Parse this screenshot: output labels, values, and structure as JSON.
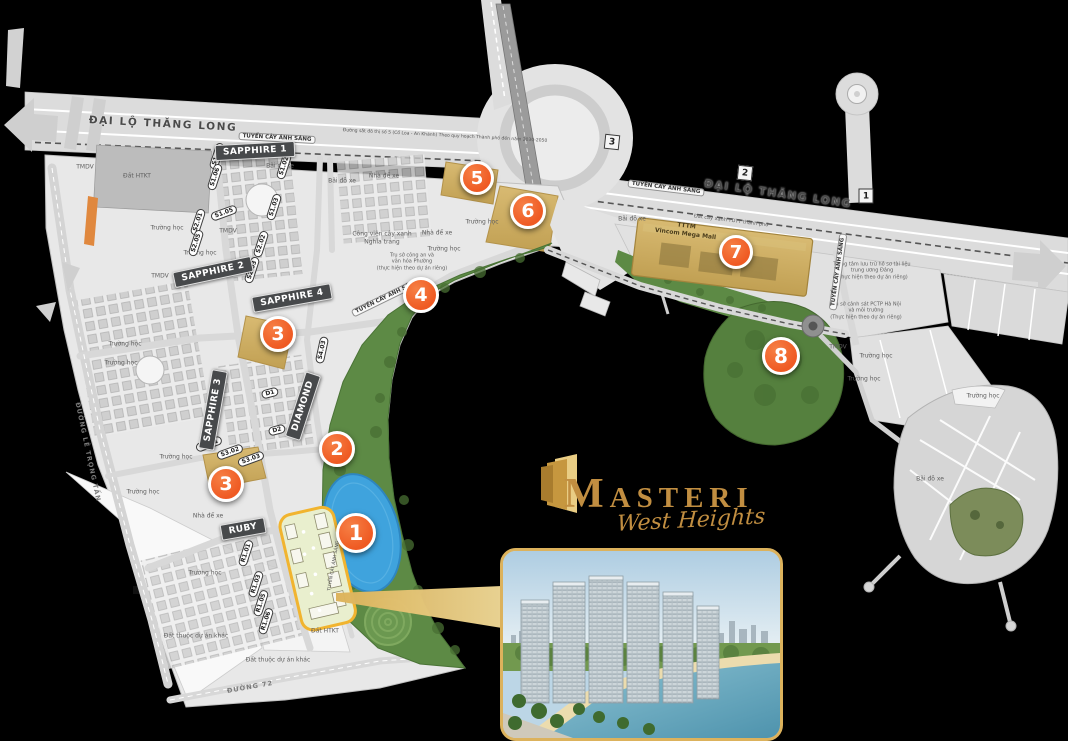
{
  "canvas": {
    "width": 1068,
    "height": 741,
    "background": "#000000"
  },
  "colors": {
    "marker_orange": "#ef5a23",
    "zone_badge": "#47494b",
    "gold": "#c18e41",
    "site_outline": "#f1b42f",
    "park_green": "#5d8a45",
    "lake_blue": "#3fa3dd",
    "mall_tan": "#c9ab61",
    "inset_border": "#dcb25c"
  },
  "logo": {
    "brand": "MASTERI",
    "subbrand": "West Heights"
  },
  "markers": [
    {
      "n": "1",
      "x": 356,
      "y": 533,
      "r": 17
    },
    {
      "n": "2",
      "x": 337,
      "y": 449,
      "r": 15
    },
    {
      "n": "3",
      "x": 278,
      "y": 334,
      "r": 15
    },
    {
      "n": "3",
      "x": 226,
      "y": 484,
      "r": 15
    },
    {
      "n": "4",
      "x": 421,
      "y": 295,
      "r": 15
    },
    {
      "n": "5",
      "x": 477,
      "y": 178,
      "r": 14
    },
    {
      "n": "6",
      "x": 528,
      "y": 211,
      "r": 15
    },
    {
      "n": "7",
      "x": 736,
      "y": 252,
      "r": 14
    },
    {
      "n": "8",
      "x": 781,
      "y": 356,
      "r": 16
    }
  ],
  "road_badges": [
    {
      "n": "3",
      "x": 612,
      "y": 142,
      "rot": 6
    },
    {
      "n": "2",
      "x": 745,
      "y": 173,
      "rot": 6
    },
    {
      "n": "1",
      "x": 866,
      "y": 196,
      "rot": 0
    }
  ],
  "zone_badges": [
    {
      "t": "SAPPHIRE 1",
      "x": 255,
      "y": 151,
      "rot": -3
    },
    {
      "t": "SAPPHIRE 2",
      "x": 213,
      "y": 272,
      "rot": -12
    },
    {
      "t": "SAPPHIRE 4",
      "x": 292,
      "y": 298,
      "rot": -10
    },
    {
      "t": "SAPPHIRE 3",
      "x": 213,
      "y": 410,
      "rot": -80
    },
    {
      "t": "DIAMOND",
      "x": 303,
      "y": 406,
      "rot": -72
    },
    {
      "t": "RUBY",
      "x": 243,
      "y": 529,
      "rot": -10
    }
  ],
  "unit_labels": [
    {
      "t": "S1.01",
      "x": 217,
      "y": 156,
      "rot": -72
    },
    {
      "t": "S1.06",
      "x": 215,
      "y": 177,
      "rot": -72
    },
    {
      "t": "S1.02",
      "x": 284,
      "y": 166,
      "rot": -72
    },
    {
      "t": "S1.03",
      "x": 274,
      "y": 207,
      "rot": -72
    },
    {
      "t": "S1.05",
      "x": 224,
      "y": 213,
      "rot": -20
    },
    {
      "t": "S2.01",
      "x": 198,
      "y": 222,
      "rot": -72
    },
    {
      "t": "S2.05",
      "x": 196,
      "y": 243,
      "rot": -72
    },
    {
      "t": "S2.02",
      "x": 261,
      "y": 244,
      "rot": -72
    },
    {
      "t": "S2.03",
      "x": 252,
      "y": 270,
      "rot": -72
    },
    {
      "t": "S3.01",
      "x": 209,
      "y": 444,
      "rot": -20
    },
    {
      "t": "S3.02",
      "x": 230,
      "y": 452,
      "rot": -20
    },
    {
      "t": "S3.03",
      "x": 251,
      "y": 459,
      "rot": -20
    },
    {
      "t": "S4.03",
      "x": 322,
      "y": 350,
      "rot": -78
    },
    {
      "t": "D1",
      "x": 270,
      "y": 393,
      "rot": -15
    },
    {
      "t": "D2",
      "x": 277,
      "y": 430,
      "rot": -15
    },
    {
      "t": "R1.01",
      "x": 246,
      "y": 553,
      "rot": -72
    },
    {
      "t": "R1.03",
      "x": 256,
      "y": 584,
      "rot": -72
    },
    {
      "t": "R1.05",
      "x": 261,
      "y": 603,
      "rot": -72
    },
    {
      "t": "R1.06",
      "x": 266,
      "y": 621,
      "rot": -72
    }
  ],
  "road_labels": [
    {
      "t": "ĐẠI LỘ THĂNG LONG",
      "x": 163,
      "y": 124,
      "rot": 3,
      "cls": "major"
    },
    {
      "t": "ĐẠI LỘ THĂNG LONG",
      "x": 778,
      "y": 194,
      "rot": 8,
      "cls": "major"
    },
    {
      "t": "TUYẾN CÂY ÁNH SÁNG",
      "x": 277,
      "y": 138,
      "rot": 3,
      "cls": "minor"
    },
    {
      "t": "TUYẾN CÂY ÁNH SÁNG",
      "x": 666,
      "y": 188,
      "rot": 7,
      "cls": "minor"
    },
    {
      "t": "TUYẾN CÂY ÁNH SÁNG",
      "x": 838,
      "y": 272,
      "rot": -82,
      "cls": "minor"
    },
    {
      "t": "TUYẾN CÂY ÁNH SÁNG",
      "x": 387,
      "y": 297,
      "rot": -26,
      "cls": "minor"
    },
    {
      "t": "TUYẾN CÂY ÁNH SÁNG",
      "x": 334,
      "y": 566,
      "rot": -80,
      "cls": "tinyroad"
    },
    {
      "t": "ĐƯỜNG LÊ TRỌNG TẤN",
      "x": 88,
      "y": 452,
      "rot": 78,
      "cls": "plain"
    },
    {
      "t": "ĐƯỜNG 72",
      "x": 250,
      "y": 687,
      "rot": -10,
      "cls": "plain"
    },
    {
      "t": "Đường sắt đô thị số 5 (Cổ Loa - An Khánh) Theo quy hoạch Thành phố đến năm 2030-2050",
      "x": 445,
      "y": 136,
      "rot": 3,
      "cls": "tinyroad"
    }
  ],
  "area_labels": [
    {
      "t": "Đất HTKT",
      "x": 137,
      "y": 176
    },
    {
      "t": "TMDV",
      "x": 85,
      "y": 167
    },
    {
      "t": "TMDV",
      "x": 160,
      "y": 276
    },
    {
      "t": "TMDV",
      "x": 228,
      "y": 231
    },
    {
      "t": "Bãi đỗ xe",
      "x": 280,
      "y": 166
    },
    {
      "t": "Bãi đỗ xe",
      "x": 342,
      "y": 181
    },
    {
      "t": "Nhà để xe",
      "x": 384,
      "y": 176
    },
    {
      "t": "Nhà để xe",
      "x": 437,
      "y": 233
    },
    {
      "t": "Trường học",
      "x": 167,
      "y": 228
    },
    {
      "t": "Trường học",
      "x": 200,
      "y": 253
    },
    {
      "t": "Trường học",
      "x": 125,
      "y": 344
    },
    {
      "t": "Trường học",
      "x": 121,
      "y": 363
    },
    {
      "t": "Trường học",
      "x": 176,
      "y": 457
    },
    {
      "t": "Trường học",
      "x": 143,
      "y": 492
    },
    {
      "t": "Trường học",
      "x": 205,
      "y": 573
    },
    {
      "t": "Trường học",
      "x": 482,
      "y": 222
    },
    {
      "t": "Trường học",
      "x": 444,
      "y": 249
    },
    {
      "t": "Công viên cây xanh\nNghĩa trang",
      "x": 382,
      "y": 238
    },
    {
      "t": "Trụ sở công an và\nvăn hóa Phường\n(thực hiện theo dự án riêng)",
      "x": 412,
      "y": 262,
      "fs": 5
    },
    {
      "t": "Nhà để xe",
      "x": 208,
      "y": 516
    },
    {
      "t": "Đất thuộc dự án khác",
      "x": 196,
      "y": 636
    },
    {
      "t": "Đất thuộc dự án khác",
      "x": 278,
      "y": 660
    },
    {
      "t": "Đất HTKT",
      "x": 325,
      "y": 631
    },
    {
      "t": "Bãi đỗ xe",
      "x": 632,
      "y": 219
    },
    {
      "t": "Đất cây xanh TDTT thành phố",
      "x": 731,
      "y": 221,
      "rot": 7,
      "fs": 5
    },
    {
      "t": "TTTM\nVincom Mega Mall",
      "x": 686,
      "y": 230,
      "rot": 7,
      "cls": "bold",
      "fs": 6
    },
    {
      "t": "Trung tâm lưu trữ hồ sơ tài liệu\ntrung ương Đảng\n(Thực hiện theo dự án riêng)",
      "x": 872,
      "y": 271,
      "fs": 5
    },
    {
      "t": "Trụ sở cảnh sát PCTP Hà Nội\nvà môi trường\n(Thực hiện theo dự án riêng)",
      "x": 866,
      "y": 311,
      "fs": 5
    },
    {
      "t": "TMDV",
      "x": 838,
      "y": 347
    },
    {
      "t": "Trường học",
      "x": 876,
      "y": 356
    },
    {
      "t": "Trường học",
      "x": 864,
      "y": 379
    },
    {
      "t": "Trường học",
      "x": 983,
      "y": 396
    },
    {
      "t": "Bãi đỗ xe",
      "x": 930,
      "y": 479
    }
  ]
}
